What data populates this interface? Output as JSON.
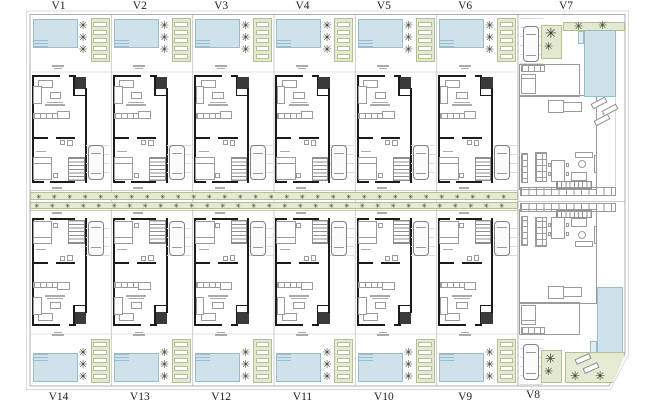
{
  "labels": {
    "top": [
      "V1",
      "V2",
      "V3",
      "V4",
      "V5",
      "V6",
      "V7"
    ],
    "bottom": [
      "V14",
      "V13",
      "V12",
      "V11",
      "V10",
      "V9",
      "V8"
    ]
  },
  "icons": {
    "tree": "✳"
  },
  "colors": {
    "pool_fill": "#cfe1eb",
    "pool_border": "#97bccd",
    "green_fill": "#e1e9d0",
    "green_border": "#b4c094",
    "street_green": "#e3ebd3",
    "wall": "#1b1b1b",
    "furniture_line": "#9b9b9b",
    "boundary": "#aab0b0",
    "tree": "#333a28",
    "label_color": "#222222"
  }
}
